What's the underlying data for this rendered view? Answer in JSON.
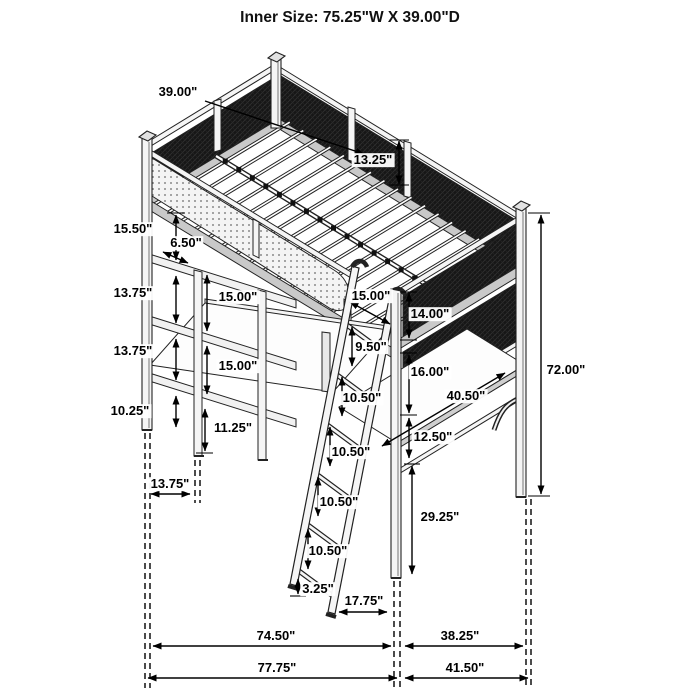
{
  "title": "Inner Size: 75.25\"W X 39.00\"D",
  "colors": {
    "line": "#1a1a1a",
    "mesh_panel": "#161616",
    "frame_shade": "#c9c9c9",
    "perforation_dot": "#8a8a8a",
    "background": "#ffffff"
  },
  "dimensions": {
    "bed_depth": "39.00\"",
    "guardrail_height": "13.25\"",
    "underbed_to_shelf1": "15.50\"",
    "shelf_depth": "6.50\"",
    "shelf_gap_rear_upper": "13.75\"",
    "shelf_gap_front_upper": "15.00\"",
    "shelf_gap_rear_lower": "13.75\"",
    "shelf_gap_front_lower": "15.00\"",
    "shelf_to_leg_end": "10.25\"",
    "shelf_post_below": "11.25\"",
    "shelf_floor_offset": "13.75\"",
    "front_corner_gap": "15.00\"",
    "upper_screen_height": "14.00\"",
    "ladder_gap_top": "9.50\"",
    "lower_screen_height": "16.00\"",
    "ladder_gap_2": "10.50\"",
    "ladder_gap_3": "10.50\"",
    "ladder_gap_4": "10.50\"",
    "ladder_gap_5": "10.50\"",
    "ladder_foot_clearance": "3.25\"",
    "ladder_foot_offset": "17.75\"",
    "desk_length": "40.50\"",
    "desk_to_rail": "12.50\"",
    "rail_to_floor": "29.25\"",
    "overall_height": "72.00\"",
    "base_span_width": "74.50\"",
    "base_span_depth": "38.25\"",
    "overall_width": "77.75\"",
    "overall_depth": "41.50\""
  }
}
